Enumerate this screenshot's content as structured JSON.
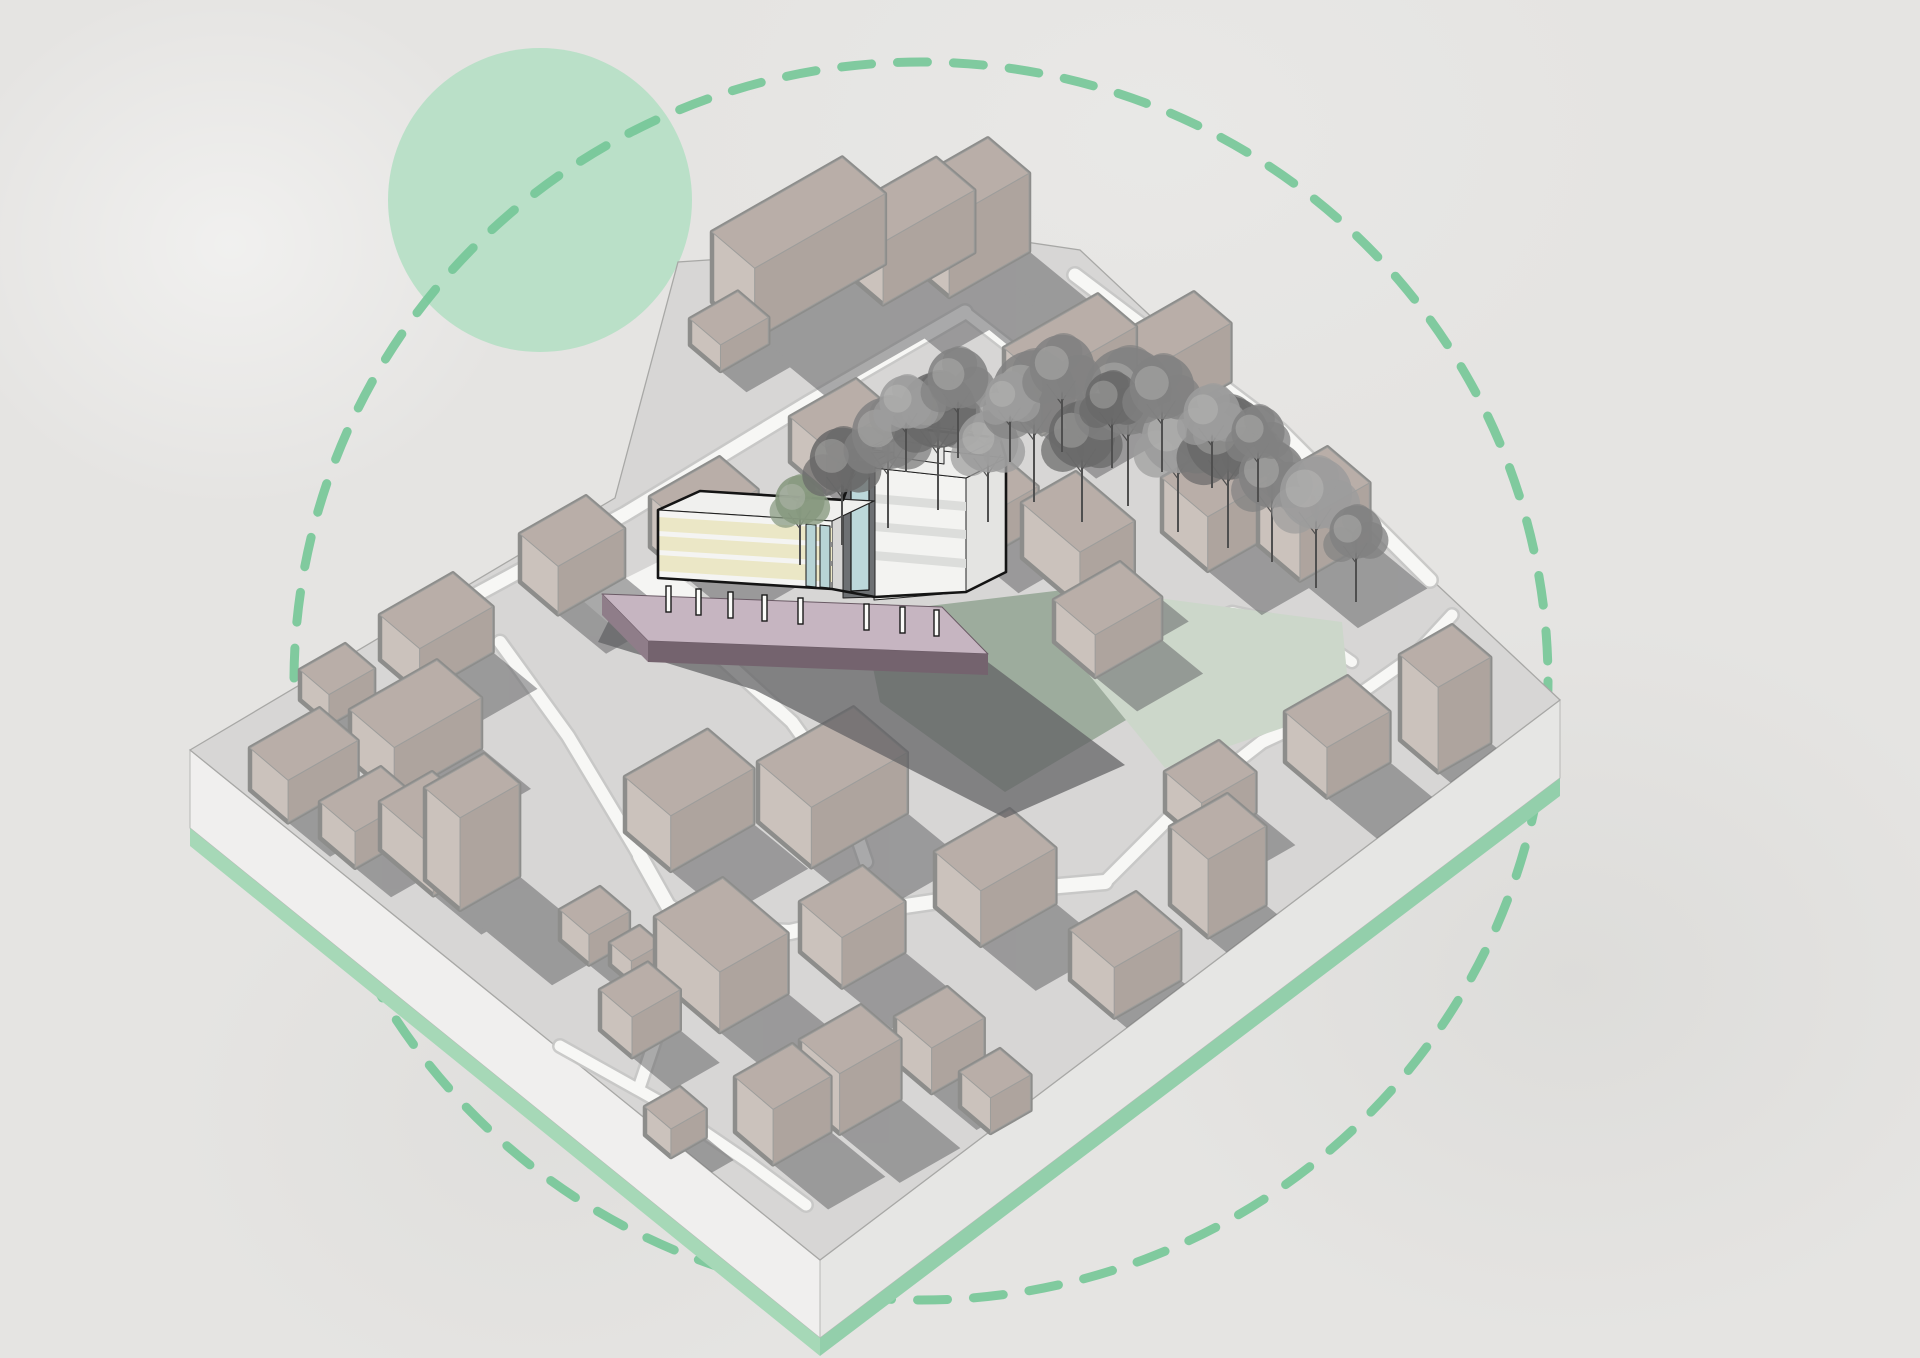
{
  "canvas": {
    "width": 1920,
    "height": 1358,
    "background": "#e5e4e2"
  },
  "palette": {
    "paper": "#e5e4e2",
    "plate_top": "#d7d6d5",
    "plate_side_left": "#f0efee",
    "plate_side_right": "#e6e6e4",
    "plate_green_left": "#a6d8b7",
    "plate_green_right": "#93cfab",
    "plate_edge": "#a8a8a6",
    "road_fill": "#f7f7f5",
    "road_casing": "#c7c7c5",
    "building_top": "#b9aea8",
    "building_left": "#cbc2bc",
    "building_right": "#aea49e",
    "building_outline": "#8d8d8b",
    "shadow": "#5e5e61",
    "accent_green_solid": "#b7dfc6",
    "accent_green_dash": "#74c697",
    "featured_cream": "#ebe7c6",
    "featured_white": "#f4f4f2",
    "featured_core": "#6d7073",
    "featured_glass": "#b7d3d5",
    "featured_plinth_top": "#c6b5c1",
    "featured_plinth_front": "#74636e",
    "featured_outline": "#141414",
    "lawn_sage": "#9dac9d",
    "lawn_pale": "#ccd7ca"
  },
  "decor": {
    "solid_circle": {
      "cx": 540,
      "cy": 200,
      "r": 152,
      "fill": "#b7dfc6",
      "opacity": 0.95
    },
    "dashed_circle": {
      "cx": 921,
      "cy": 681,
      "rx": 627,
      "ry": 619,
      "stroke": "#74c697",
      "stroke_width": 9,
      "dash": "30 26",
      "opacity": 0.9
    }
  },
  "projection": {
    "A": [
      0.868,
      -0.496
    ],
    "B": [
      0.762,
      0.647
    ],
    "shadow_dir": [
      1.0,
      0.82
    ],
    "shadow_opacity": 0.5
  },
  "plate": {
    "top": [
      [
        190,
        750
      ],
      [
        615,
        498
      ],
      [
        678,
        262
      ],
      [
        1012,
        240
      ],
      [
        1080,
        250
      ],
      [
        1560,
        700
      ],
      [
        820,
        1260
      ]
    ],
    "left_corner": [
      190,
      750
    ],
    "bottom_corner": [
      820,
      1260
    ],
    "right_corner": [
      1560,
      700
    ],
    "side_height": 78,
    "green_height": 18
  },
  "roads": [
    {
      "w": 13,
      "pts": [
        [
          470,
          598
        ],
        [
          625,
          514
        ],
        [
          808,
          403
        ],
        [
          965,
          312
        ]
      ]
    },
    {
      "w": 13,
      "pts": [
        [
          1075,
          275
        ],
        [
          1280,
          430
        ],
        [
          1430,
          580
        ]
      ]
    },
    {
      "w": 10,
      "pts": [
        [
          965,
          312
        ],
        [
          1042,
          372
        ],
        [
          1096,
          436
        ]
      ]
    },
    {
      "w": 12,
      "pts": [
        [
          500,
          642
        ],
        [
          568,
          736
        ],
        [
          634,
          846
        ],
        [
          676,
          918
        ]
      ]
    },
    {
      "w": 14,
      "pts": [
        [
          640,
          856
        ],
        [
          668,
          906
        ],
        [
          702,
          928
        ],
        [
          790,
          932
        ],
        [
          905,
          906
        ],
        [
          1014,
          890
        ],
        [
          1105,
          882
        ]
      ]
    },
    {
      "w": 11,
      "pts": [
        [
          702,
          928
        ],
        [
          678,
          978
        ],
        [
          658,
          1032
        ],
        [
          640,
          1085
        ]
      ]
    },
    {
      "w": 11,
      "pts": [
        [
          560,
          1046
        ],
        [
          660,
          1102
        ],
        [
          748,
          1162
        ],
        [
          806,
          1205
        ]
      ]
    },
    {
      "w": 12,
      "pts": [
        [
          640,
          620
        ],
        [
          724,
          660
        ],
        [
          792,
          722
        ],
        [
          842,
          792
        ],
        [
          866,
          862
        ]
      ]
    },
    {
      "w": 12,
      "pts": [
        [
          1105,
          882
        ],
        [
          1185,
          802
        ],
        [
          1262,
          742
        ],
        [
          1348,
          702
        ]
      ]
    },
    {
      "w": 11,
      "pts": [
        [
          1348,
          702
        ],
        [
          1415,
          655
        ],
        [
          1452,
          615
        ]
      ]
    },
    {
      "w": 10,
      "pts": [
        [
          1150,
          642
        ],
        [
          1232,
          612
        ],
        [
          1302,
          627
        ],
        [
          1352,
          662
        ]
      ]
    }
  ],
  "plazas": [
    {
      "fill": "#f5f5f3",
      "pts": [
        [
          582,
          600
        ],
        [
          658,
          562
        ],
        [
          702,
          594
        ],
        [
          626,
          638
        ]
      ]
    }
  ],
  "lawns": [
    {
      "fill": "#9dac9d",
      "pts": [
        [
          862,
          614
        ],
        [
          1080,
          588
        ],
        [
          1190,
          682
        ],
        [
          1005,
          792
        ],
        [
          880,
          702
        ]
      ]
    },
    {
      "fill": "#ccd7ca",
      "pts": [
        [
          1080,
          588
        ],
        [
          1342,
          622
        ],
        [
          1350,
          705
        ],
        [
          1165,
          768
        ],
        [
          1082,
          666
        ]
      ]
    }
  ],
  "buildings": [
    [
      690,
      345,
      55,
      40,
      26
    ],
    [
      712,
      302,
      150,
      56,
      70
    ],
    [
      845,
      272,
      105,
      50,
      62
    ],
    [
      908,
      262,
      92,
      54,
      78
    ],
    [
      1004,
      402,
      108,
      50,
      54
    ],
    [
      1114,
      396,
      92,
      48,
      58
    ],
    [
      1162,
      532,
      95,
      60,
      54
    ],
    [
      1258,
      545,
      80,
      55,
      58
    ],
    [
      1400,
      740,
      60,
      50,
      85
    ],
    [
      1054,
      642,
      76,
      54,
      42
    ],
    [
      945,
      532,
      68,
      44,
      40
    ],
    [
      1022,
      558,
      62,
      76,
      55
    ],
    [
      300,
      700,
      52,
      38,
      30
    ],
    [
      380,
      660,
      84,
      52,
      45
    ],
    [
      350,
      760,
      100,
      58,
      50
    ],
    [
      250,
      790,
      80,
      50,
      42
    ],
    [
      320,
      838,
      70,
      46,
      36
    ],
    [
      380,
      850,
      60,
      70,
      48
    ],
    [
      425,
      880,
      68,
      46,
      92
    ],
    [
      560,
      940,
      46,
      38,
      30
    ],
    [
      610,
      965,
      34,
      28,
      22
    ],
    [
      520,
      582,
      76,
      50,
      48
    ],
    [
      650,
      547,
      80,
      50,
      50
    ],
    [
      790,
      462,
      76,
      48,
      45
    ],
    [
      625,
      832,
      95,
      60,
      55
    ],
    [
      758,
      822,
      110,
      70,
      60
    ],
    [
      655,
      977,
      78,
      85,
      60
    ],
    [
      800,
      952,
      72,
      55,
      50
    ],
    [
      935,
      907,
      86,
      60,
      55
    ],
    [
      895,
      1062,
      60,
      48,
      45
    ],
    [
      960,
      1107,
      46,
      40,
      35
    ],
    [
      1070,
      980,
      76,
      58,
      50
    ],
    [
      1165,
      812,
      62,
      48,
      40
    ],
    [
      1285,
      762,
      72,
      55,
      50
    ],
    [
      1170,
      905,
      66,
      50,
      78
    ],
    [
      600,
      1030,
      55,
      42,
      40
    ],
    [
      645,
      1135,
      40,
      34,
      28
    ],
    [
      735,
      1132,
      66,
      50,
      55
    ],
    [
      800,
      1100,
      70,
      52,
      60
    ]
  ],
  "featured": {
    "columns": [
      [
        666,
        586
      ],
      [
        696,
        589
      ],
      [
        728,
        592
      ],
      [
        762,
        595
      ],
      [
        798,
        598
      ],
      [
        864,
        604
      ],
      [
        900,
        607
      ],
      [
        934,
        610
      ]
    ],
    "column_w": 5,
    "column_h": 26,
    "shapes": [
      {
        "f": "#5f5f62",
        "o": 0.72,
        "p": [
          [
            612,
            614
          ],
          [
            945,
            630
          ],
          [
            1125,
            765
          ],
          [
            1005,
            818
          ],
          [
            755,
            690
          ],
          [
            598,
            642
          ]
        ]
      },
      {
        "f": "#c6b5c1",
        "s": "#6a5a65",
        "w": 1,
        "p": [
          [
            602,
            594
          ],
          [
            942,
            607
          ],
          [
            988,
            654
          ],
          [
            648,
            641
          ]
        ]
      },
      {
        "f": "#8f7d89",
        "p": [
          [
            602,
            594
          ],
          [
            648,
            641
          ],
          [
            648,
            662
          ],
          [
            602,
            615
          ]
        ]
      },
      {
        "f": "#74636e",
        "p": [
          [
            648,
            641
          ],
          [
            988,
            654
          ],
          [
            988,
            675
          ],
          [
            648,
            662
          ]
        ]
      },
      {
        "f": "#ececea",
        "s": "#222222",
        "w": 1.2,
        "p": [
          [
            866,
            449
          ],
          [
            910,
            428
          ],
          [
            1000,
            438
          ],
          [
            956,
            460
          ]
        ]
      },
      {
        "f": "#e4e4e2",
        "s": "#222222",
        "w": 1,
        "p": [
          [
            966,
            478
          ],
          [
            1006,
            458
          ],
          [
            1006,
            572
          ],
          [
            966,
            592
          ]
        ]
      },
      {
        "f": "#f3f3f1",
        "s": "#222222",
        "w": 1,
        "p": [
          [
            874,
            468
          ],
          [
            966,
            478
          ],
          [
            966,
            592
          ],
          [
            874,
            600
          ]
        ]
      },
      {
        "f": "#dcdddb",
        "p": [
          [
            874,
            494
          ],
          [
            966,
            502
          ],
          [
            966,
            511
          ],
          [
            874,
            503
          ]
        ]
      },
      {
        "f": "#dcdddb",
        "p": [
          [
            874,
            522
          ],
          [
            966,
            530
          ],
          [
            966,
            539
          ],
          [
            874,
            531
          ]
        ]
      },
      {
        "f": "#dcdddb",
        "p": [
          [
            874,
            551
          ],
          [
            966,
            559
          ],
          [
            966,
            568
          ],
          [
            874,
            560
          ]
        ]
      },
      {
        "f": "#efefed",
        "s": "#222222",
        "w": 1,
        "p": [
          [
            874,
            468
          ],
          [
            916,
            448
          ],
          [
            1006,
            458
          ],
          [
            966,
            478
          ]
        ]
      },
      {
        "f": "#f1f1ef",
        "s": "#222222",
        "w": 1,
        "p": [
          [
            894,
            440
          ],
          [
            924,
            426
          ],
          [
            974,
            432
          ],
          [
            944,
            447
          ]
        ]
      },
      {
        "f": "#e8e8e6",
        "s": "#222222",
        "w": 1,
        "p": [
          [
            894,
            440
          ],
          [
            944,
            447
          ],
          [
            944,
            464
          ],
          [
            894,
            457
          ]
        ]
      },
      {
        "f": "#8a8d8f",
        "s": "#222222",
        "w": 1,
        "p": [
          [
            843,
            462
          ],
          [
            860,
            453
          ],
          [
            892,
            452
          ],
          [
            875,
            461
          ]
        ]
      },
      {
        "f": "#6d7073",
        "s": "#222222",
        "w": 1,
        "p": [
          [
            843,
            462
          ],
          [
            875,
            461
          ],
          [
            875,
            597
          ],
          [
            843,
            598
          ]
        ]
      },
      {
        "f": "#bcd8da",
        "s": "#161616",
        "w": 1.2,
        "p": [
          [
            851,
            470
          ],
          [
            869,
            469
          ],
          [
            869,
            590
          ],
          [
            851,
            591
          ]
        ]
      },
      {
        "f": "#f0f0ee",
        "s": "#222222",
        "w": 1.2,
        "p": [
          [
            658,
            510
          ],
          [
            700,
            491
          ],
          [
            874,
            501
          ],
          [
            832,
            521
          ]
        ]
      },
      {
        "f": "#f4f4f2",
        "s": "#222222",
        "w": 1,
        "p": [
          [
            658,
            510
          ],
          [
            832,
            521
          ],
          [
            832,
            589
          ],
          [
            658,
            578
          ]
        ]
      },
      {
        "f": "#ebe7c6",
        "p": [
          [
            658,
            517
          ],
          [
            832,
            528
          ],
          [
            832,
            542
          ],
          [
            658,
            531
          ]
        ]
      },
      {
        "f": "#ebe7c6",
        "p": [
          [
            658,
            536
          ],
          [
            832,
            547
          ],
          [
            832,
            561
          ],
          [
            658,
            550
          ]
        ]
      },
      {
        "f": "#ebe7c6",
        "p": [
          [
            658,
            555
          ],
          [
            832,
            566
          ],
          [
            832,
            582
          ],
          [
            658,
            571
          ]
        ]
      },
      {
        "f": "#b7d3d5",
        "s": "#161616",
        "w": 1,
        "p": [
          [
            806,
            524
          ],
          [
            816,
            525
          ],
          [
            816,
            587
          ],
          [
            806,
            586
          ]
        ]
      },
      {
        "f": "#b7d3d5",
        "s": "#161616",
        "w": 1,
        "p": [
          [
            820,
            525
          ],
          [
            830,
            526
          ],
          [
            830,
            588
          ],
          [
            820,
            587
          ]
        ]
      },
      {
        "f": "none",
        "s": "#141414",
        "w": 2.6,
        "p": [
          [
            658,
            510
          ],
          [
            700,
            491
          ],
          [
            843,
            500
          ],
          [
            860,
            453
          ],
          [
            894,
            440
          ],
          [
            910,
            428
          ],
          [
            1000,
            438
          ],
          [
            1006,
            458
          ],
          [
            1006,
            572
          ],
          [
            966,
            592
          ],
          [
            875,
            597
          ],
          [
            832,
            589
          ],
          [
            658,
            578
          ]
        ]
      }
    ]
  },
  "trees": {
    "tones": [
      "#6a6a6a",
      "#828282",
      "#9c9c9c",
      "#87987f"
    ],
    "trunk": "#4f4f4f",
    "items": [
      [
        800,
        565,
        26,
        3
      ],
      [
        842,
        545,
        34,
        0
      ],
      [
        888,
        528,
        38,
        1
      ],
      [
        938,
        510,
        40,
        0
      ],
      [
        988,
        522,
        32,
        2
      ],
      [
        1034,
        502,
        44,
        1
      ],
      [
        1082,
        522,
        35,
        0
      ],
      [
        1128,
        506,
        46,
        1
      ],
      [
        1178,
        532,
        38,
        2
      ],
      [
        1228,
        548,
        44,
        0
      ],
      [
        1272,
        562,
        35,
        1
      ],
      [
        1316,
        588,
        38,
        2
      ],
      [
        1356,
        602,
        28,
        1
      ],
      [
        906,
        472,
        28,
        2
      ],
      [
        958,
        458,
        32,
        1
      ],
      [
        1010,
        462,
        26,
        2
      ],
      [
        1062,
        452,
        34,
        1
      ],
      [
        1112,
        468,
        28,
        0
      ],
      [
        1162,
        472,
        34,
        1
      ],
      [
        1212,
        488,
        30,
        2
      ],
      [
        1258,
        502,
        28,
        1
      ]
    ]
  }
}
